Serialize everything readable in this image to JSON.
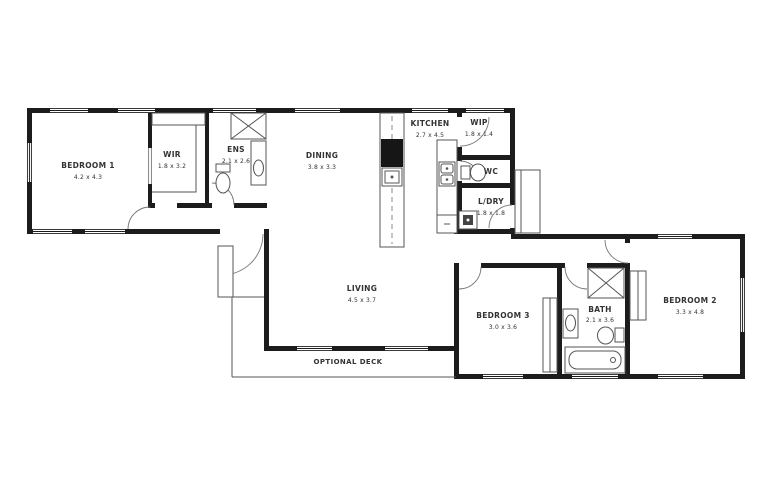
{
  "plan_title": "floor-plan",
  "rooms": [
    {
      "name": "BEDROOM 1",
      "dims": "4.2 x 4.3"
    },
    {
      "name": "WIR",
      "dims": "1.8 x 3.2"
    },
    {
      "name": "ENS",
      "dims": "2.1 x 2.6"
    },
    {
      "name": "DINING",
      "dims": "3.8 x 3.3"
    },
    {
      "name": "KITCHEN",
      "dims": "2.7 x 4.5"
    },
    {
      "name": "WIP",
      "dims": "1.8 x 1.4"
    },
    {
      "name": "WC",
      "dims": ""
    },
    {
      "name": "L/DRY",
      "dims": "1.8 x 1.8"
    },
    {
      "name": "LIVING",
      "dims": "4.5 x 3.7"
    },
    {
      "name": "BEDROOM 3",
      "dims": "3.0 x 3.6"
    },
    {
      "name": "BATH",
      "dims": "2.1 x 3.6"
    },
    {
      "name": "BEDROOM 2",
      "dims": "3.3 x 4.8"
    }
  ],
  "deck": {
    "label": "OPTIONAL DECK"
  },
  "colors": {
    "wall": "#1c1c1c",
    "line": "#555555",
    "text": "#333333",
    "background": "#ffffff"
  }
}
